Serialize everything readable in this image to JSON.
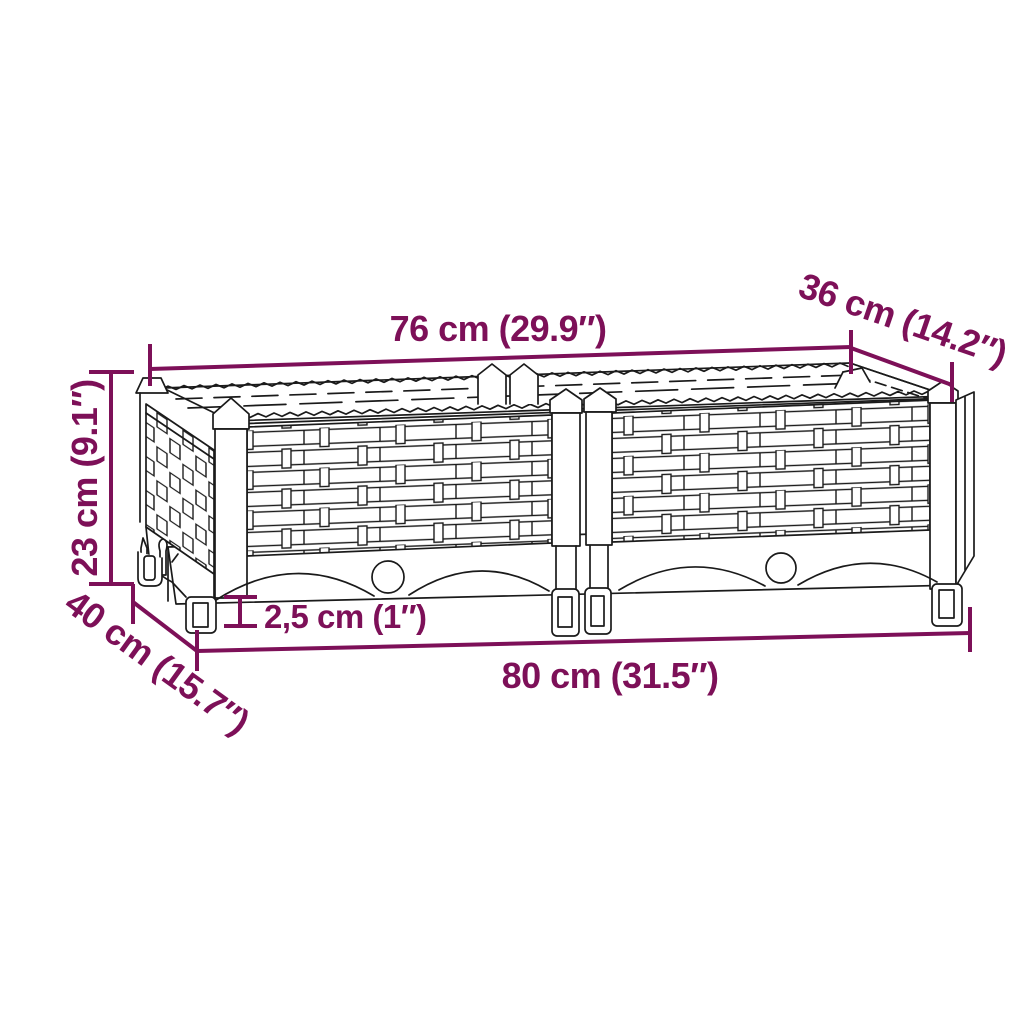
{
  "diagram": {
    "background": "#ffffff",
    "line_color": "#1a1a1a",
    "dimension_color": "#7d1058",
    "dimensions": {
      "top_width": "76 cm (29.9″)",
      "top_depth": "36 cm (14.2″)",
      "height": "23 cm (9.1″)",
      "base_depth": "40 cm (15.7″)",
      "leg_height": "2,5 cm (1″)",
      "base_width": "80 cm (31.5″)"
    }
  }
}
